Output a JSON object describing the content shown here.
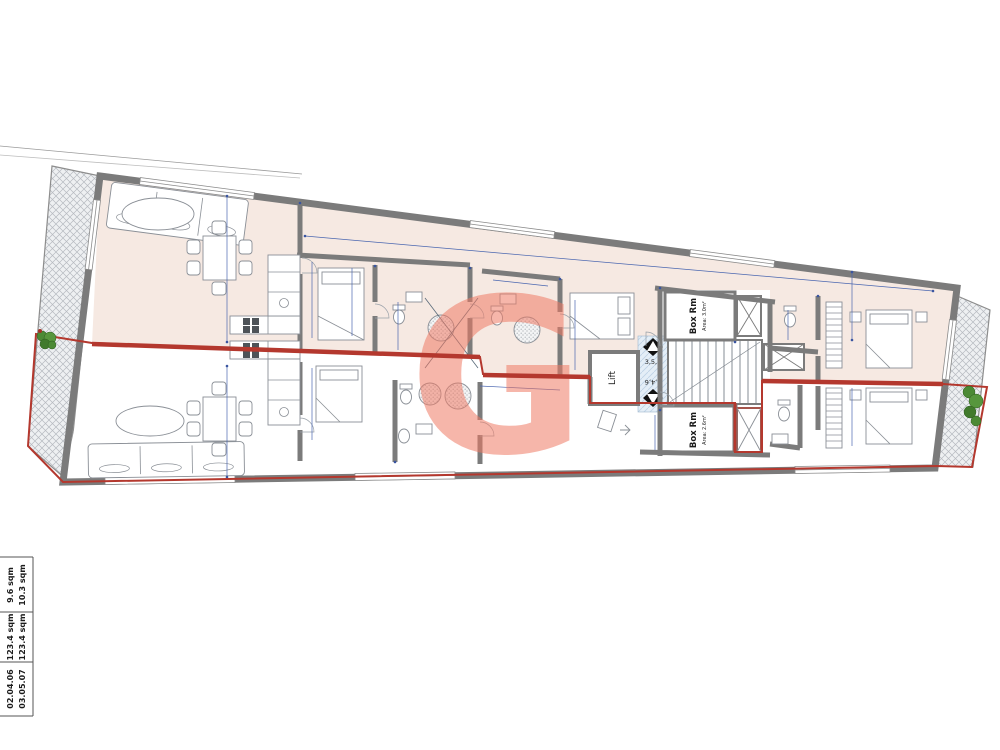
{
  "page": {
    "background": "#ffffff",
    "kind": "apartment floor plan"
  },
  "watermark": {
    "letter": "G",
    "color": "#ef7a64"
  },
  "colors": {
    "upper_unit_floor": "#f6e9e2",
    "lower_unit_floor": "#ffffff",
    "walls": "#7b7b7b",
    "unit_outline_red": "#b4382e",
    "dimension_blue": "#4a66b0",
    "core_landing_blue": "#e4eef7",
    "terrace_hatch": "#b6bac0",
    "plant_green": "#4c8a35"
  },
  "core": {
    "lift_label": "Lift",
    "upper_stair_floors": "3,5,7",
    "lower_stair_floors": "2,4,6",
    "box_room_upper_name": "Box Rm",
    "box_room_upper_area": "Area: 3.0m²",
    "box_room_lower_name": "Box Rm",
    "box_room_lower_area": "Area: 2.6m²"
  },
  "legend_table": {
    "rows": [
      {
        "units": "02.04.06",
        "internal_area": "123.4 sqm",
        "terrace_area": "9.6 sqm"
      },
      {
        "units": "03.05.07",
        "internal_area": "123.4 sqm",
        "terrace_area": "10.3 sqm"
      }
    ]
  }
}
